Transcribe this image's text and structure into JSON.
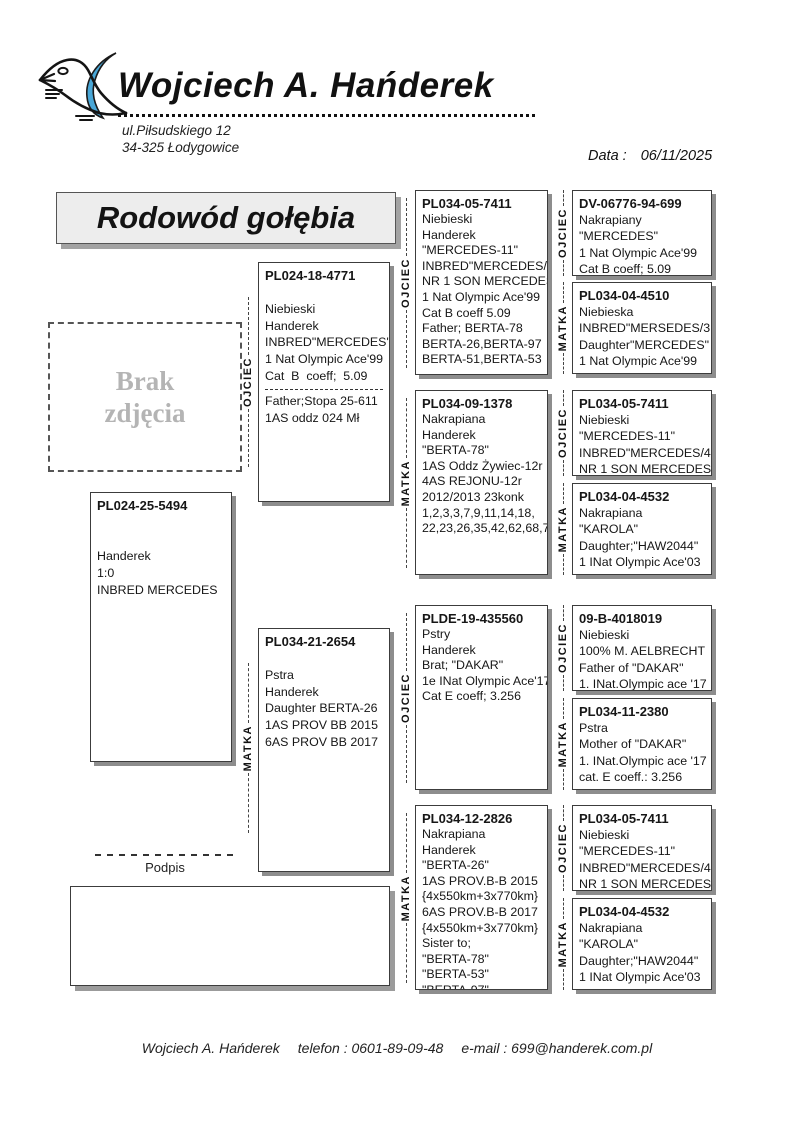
{
  "header": {
    "owner_name": "Wojciech A. Hańderek",
    "address_line1": "ul.Piłsudskiego 12",
    "address_line2": "34-325 Łodygowice",
    "date_label": "Data :",
    "date_value": "06/11/2025"
  },
  "title": "Rodowód gołębia",
  "photo_placeholder": {
    "line1": "Brak",
    "line2": "zdjęcia"
  },
  "signature_label": "Podpis",
  "footer": {
    "name": "Wojciech A. Hańderek",
    "phone": "telefon : 0601-89-09-48",
    "email": "e-mail : 699@handerek.com.pl"
  },
  "colors": {
    "logo_wing_blue": "#49a7d7",
    "title_box_bg": "#ededed",
    "box_shadow_gray": "#8d8d8d",
    "photo_text_gray": "#b4b4b4"
  },
  "role_labels": {
    "father": "OJCIEC",
    "mother": "MATKA"
  },
  "pedigree": {
    "boxes": [
      {
        "slot": "subject",
        "role": null,
        "ring": "PL024-25-5494",
        "lines": [
          "",
          "",
          "Handerek",
          "1:0",
          "INBRED MERCEDES"
        ]
      },
      {
        "slot": "g2-father",
        "role": "OJCIEC",
        "ring": "PL024-18-4771",
        "lines": [
          "",
          "Niebieski",
          "Handerek",
          "INBRED\"MERCEDES\"",
          "1 Nat Olympic Ace'99",
          "Cat  B  coeff;  5.09"
        ],
        "divider": true,
        "lines2": [
          "Father;Stopa 25-611",
          "1AS oddz 024 Mł"
        ]
      },
      {
        "slot": "g2-mother",
        "role": "MATKA",
        "ring": "PL034-21-2654",
        "lines": [
          "",
          "Pstra",
          "Handerek",
          "Daughter BERTA-26",
          "1AS PROV BB 2015",
          "6AS PROV BB 2017"
        ]
      },
      {
        "slot": "g3-1",
        "role": "OJCIEC",
        "ring": "PL034-05-7411",
        "lines": [
          "Niebieski",
          "Handerek",
          "\"MERCEDES-11\"",
          "INBRED\"MERCEDES/4",
          "NR 1 SON MERCEDES",
          "1 Nat Olympic Ace'99",
          "Cat B coeff 5.09",
          "Father; BERTA-78",
          "BERTA-26,BERTA-97",
          "BERTA-51,BERTA-53"
        ]
      },
      {
        "slot": "g3-2",
        "role": "MATKA",
        "ring": "PL034-09-1378",
        "lines": [
          "Nakrapiana",
          "Handerek",
          "\"BERTA-78\"",
          "1AS Oddz Żywiec-12r",
          "4AS REJONU-12r",
          "2012/2013 23konk",
          "1,2,3,3,7,9,11,14,18,",
          "22,23,26,35,42,62,68,7"
        ]
      },
      {
        "slot": "g3-3",
        "role": "OJCIEC",
        "ring": "PLDE-19-435560",
        "lines": [
          "Pstry",
          "Handerek",
          "Brat; \"DAKAR\"",
          "1e INat Olympic Ace'17",
          "Cat E coeff; 3.256"
        ]
      },
      {
        "slot": "g3-4",
        "role": "MATKA",
        "ring": "PL034-12-2826",
        "lines": [
          "Nakrapiana",
          "Handerek",
          "\"BERTA-26\"",
          "1AS PROV.B-B 2015",
          "{4x550km+3x770km}",
          "6AS PROV.B-B 2017",
          "{4x550km+3x770km}",
          "Sister to;",
          "\"BERTA-78\"",
          "\"BERTA-53\"",
          "\"BERTA-97\""
        ]
      },
      {
        "slot": "g4-1",
        "role": "OJCIEC",
        "ring": "DV-06776-94-699",
        "lines": [
          "Nakrapiany",
          "\"MERCEDES\"",
          "1 Nat Olympic Ace'99",
          "Cat B coeff; 5.09"
        ]
      },
      {
        "slot": "g4-2",
        "role": "MATKA",
        "ring": "PL034-04-4510",
        "lines": [
          "Niebieska",
          "INBRED\"MERSEDES/3",
          "Daughter\"MERCEDES\"",
          "1 Nat Olympic Ace'99"
        ]
      },
      {
        "slot": "g4-3",
        "role": "OJCIEC",
        "ring": "PL034-05-7411",
        "lines": [
          "Niebieski",
          "\"MERCEDES-11\"",
          "INBRED\"MERCEDES/4",
          "NR 1 SON MERCEDES"
        ]
      },
      {
        "slot": "g4-4",
        "role": "MATKA",
        "ring": "PL034-04-4532",
        "lines": [
          "Nakrapiana",
          "\"KAROLA\"",
          "Daughter;\"HAW2044\"",
          "1 INat Olympic Ace'03"
        ]
      },
      {
        "slot": "g4-5",
        "role": "OJCIEC",
        "ring": "09-B-4018019",
        "lines": [
          "Niebieski",
          "100% M. AELBRECHT",
          "Father of \"DAKAR\"",
          "1. INat.Olympic ace '17"
        ]
      },
      {
        "slot": "g4-6",
        "role": "MATKA",
        "ring": "PL034-11-2380",
        "lines": [
          "Pstra",
          "Mother of \"DAKAR\"",
          "1. INat.Olympic ace '17",
          "cat. E coeff.: 3.256"
        ]
      },
      {
        "slot": "g4-7",
        "role": "OJCIEC",
        "ring": "PL034-05-7411",
        "lines": [
          "Niebieski",
          "\"MERCEDES-11\"",
          "INBRED\"MERCEDES/4",
          "NR 1 SON MERCEDES"
        ]
      },
      {
        "slot": "g4-8",
        "role": "MATKA",
        "ring": "PL034-04-4532",
        "lines": [
          "Nakrapiana",
          "\"KAROLA\"",
          "Daughter;\"HAW2044\"",
          "1 INat Olympic Ace'03"
        ]
      }
    ]
  }
}
